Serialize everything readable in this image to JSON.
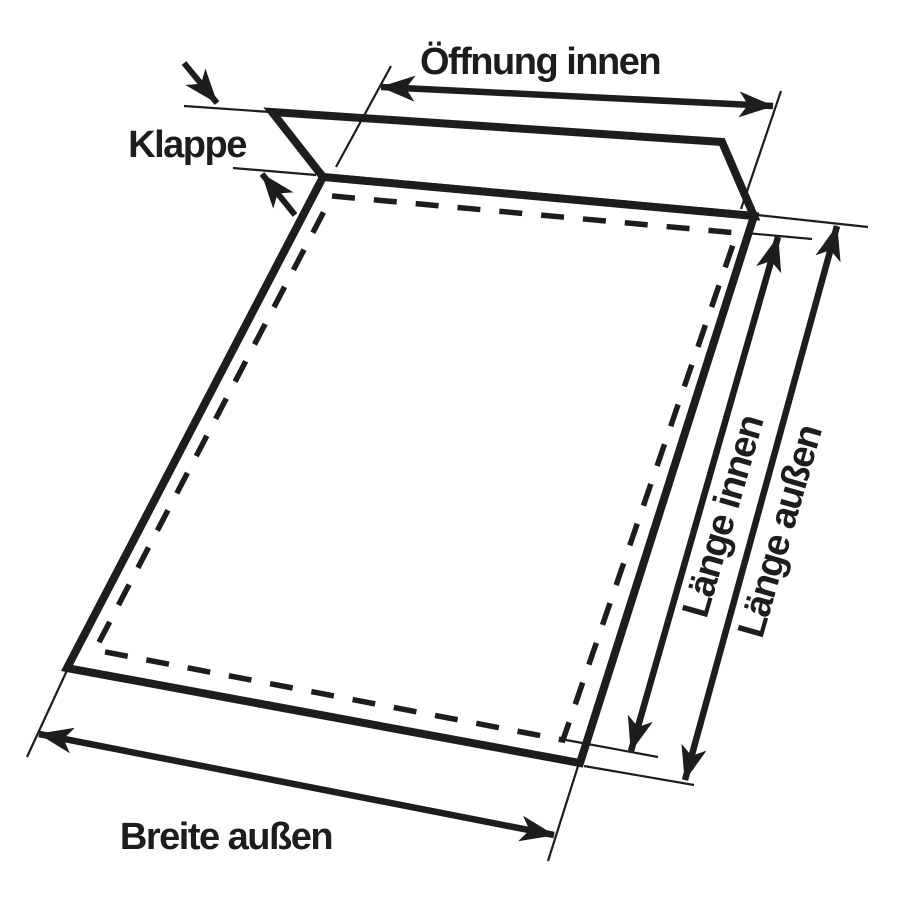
{
  "diagram": {
    "type": "envelope-dimension-diagram",
    "labels": {
      "oeffnung_innen": "Öffnung innen",
      "klappe": "Klappe",
      "laenge_innen": "Länge innen",
      "laenge_aussen": "Länge außen",
      "breite_aussen": "Breite außen"
    },
    "colors": {
      "ink": "#1d1d1b",
      "background": "#ffffff"
    }
  }
}
